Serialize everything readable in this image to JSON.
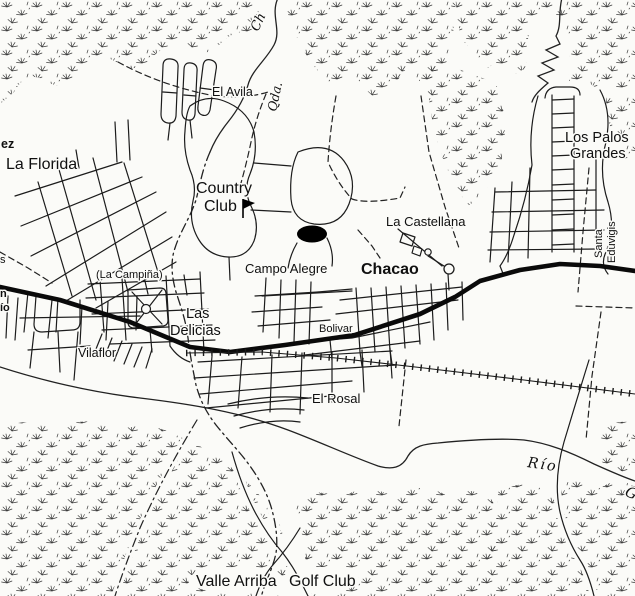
{
  "colors": {
    "ink": "#1c1c1c",
    "paper": "#fbfbf8",
    "highway": "#0a0a0a"
  },
  "labels": {
    "fragment_ez": "ez",
    "la_florida": "La Florida",
    "el_avila": "El Avila",
    "country_club": {
      "line1": "Country",
      "line2": "Club"
    },
    "quebrada": {
      "abbr": "Qda.",
      "partial": "Ch"
    },
    "los_palos_grandes": {
      "line1": "Los Palos",
      "line2": "Grandes"
    },
    "santa_eduvigis": {
      "line1": "Santa",
      "line2": "Eduvigis"
    },
    "la_castellana": "La Castellana",
    "chacao": "Chacao",
    "campo_alegre": "Campo Alegre",
    "la_campina": "(La Campiña)",
    "las_delicias": {
      "line1": "Las",
      "line2": "Delicias"
    },
    "bolivar": "Bolivar",
    "vilaflor": "Vilaflor",
    "el_rosal": "El Rosal",
    "rio": "Río",
    "rio_partial": "G",
    "valle_arriba": "Valle Arriba",
    "golf_club": "Golf Club",
    "fragment_s": "s",
    "fragment_n": "n",
    "fragment_io": "ío"
  }
}
